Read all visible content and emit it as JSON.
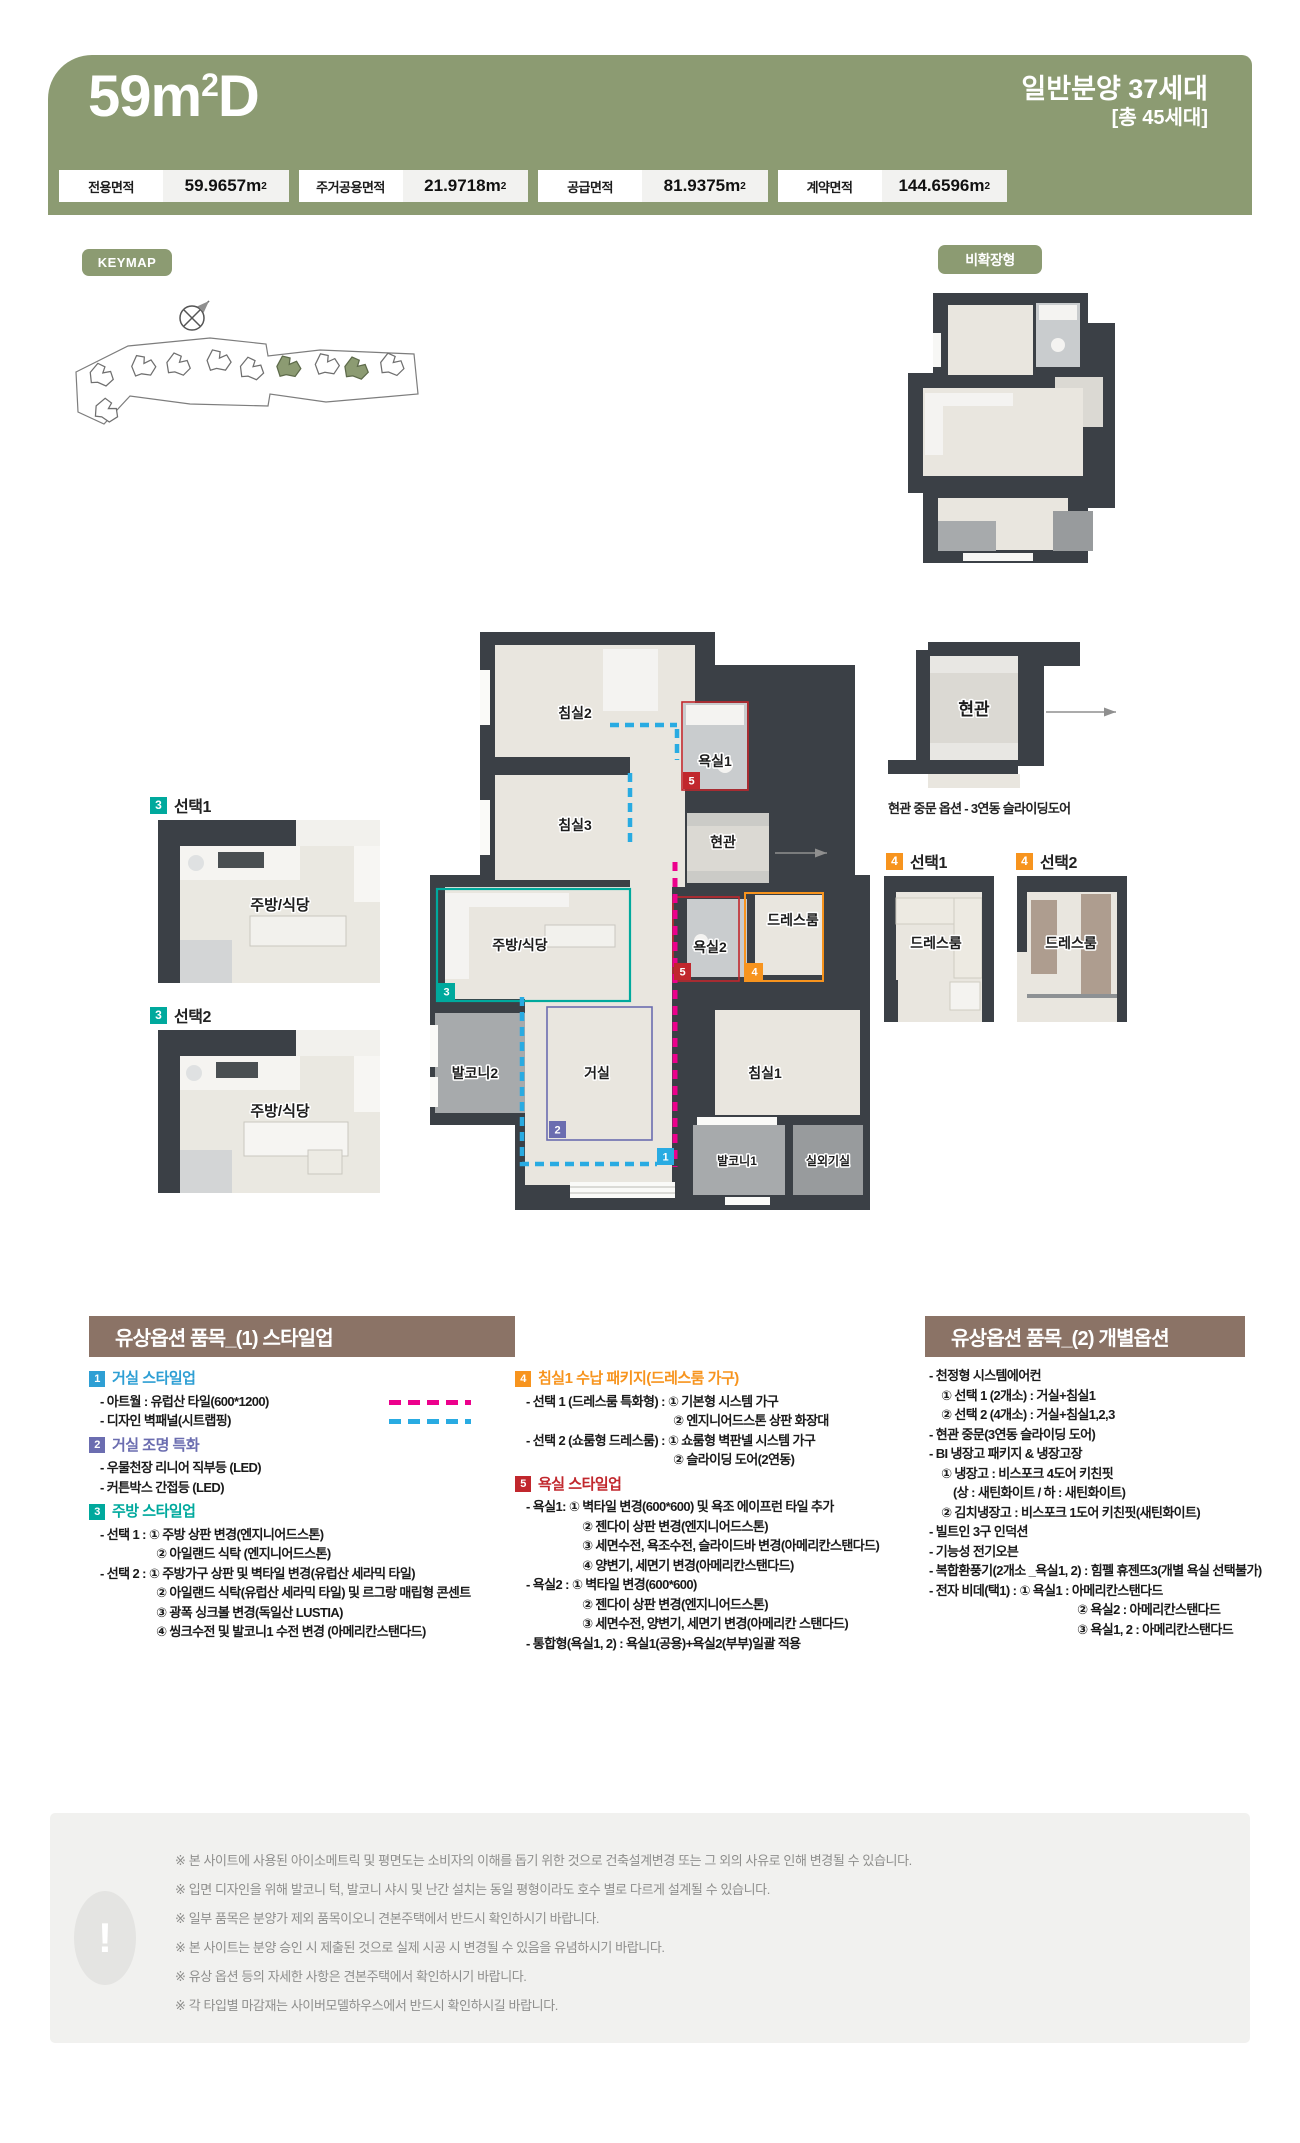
{
  "header": {
    "title_base": "59m",
    "title_sup": "2",
    "title_suffix": "D",
    "units_line1": "일반분양 37세대",
    "units_line2": "[총 45세대]",
    "olive_color": "#8C9B72",
    "areas": [
      {
        "label": "전용면적",
        "value": "59.9657",
        "unit_base": "m",
        "unit_sup": "2"
      },
      {
        "label": "주거공용면적",
        "value": "21.9718",
        "unit_base": "m",
        "unit_sup": "2"
      },
      {
        "label": "공급면적",
        "value": "81.9375",
        "unit_base": "m",
        "unit_sup": "2"
      },
      {
        "label": "계약면적",
        "value": "144.6596",
        "unit_base": "m",
        "unit_sup": "2"
      }
    ]
  },
  "keymap": {
    "badge": "KEYMAP"
  },
  "nonextended": {
    "badge": "비확장형"
  },
  "floorplan": {
    "rooms": {
      "bedroom2": "침실2",
      "bath1": "욕실1",
      "bedroom3": "침실3",
      "entrance": "현관",
      "kitchen": "주방/식당",
      "bath2": "욕실2",
      "dressroom": "드레스룸",
      "balcony2": "발코니2",
      "living": "거실",
      "bedroom1": "침실1",
      "balcony1": "발코니1",
      "outdoor": "실외기실"
    },
    "markers": {
      "m1": "1",
      "m2": "2",
      "m3": "3",
      "m4": "4",
      "m5": "5"
    },
    "marker_colors": {
      "m1": "#29ABE2",
      "m2": "#6B6DB0",
      "m3": "#00A99D",
      "m4": "#F7941E",
      "m5": "#C1272D"
    },
    "overlay_colors": {
      "magenta_dash": "#EC008C",
      "blue_dash": "#29ABE2"
    }
  },
  "side_options": {
    "kitchen": {
      "marker": "3",
      "opt1": "선택1",
      "opt2": "선택2",
      "room": "주방/식당"
    },
    "entrance": {
      "room": "현관",
      "caption": "현관 중문 옵션 - 3연동 슬라이딩도어"
    },
    "dress": {
      "marker": "4",
      "opt1": "선택1",
      "opt2": "선택2",
      "room": "드레스룸"
    }
  },
  "options1": {
    "title": "유상옵션 품목_(1) 스타일업",
    "groups": [
      {
        "num": "1",
        "heading": "거실 스타일업",
        "color": "#2E9FD4",
        "lines": [
          {
            "text": "- 아트월 : 유럽산 타일(600*1200)",
            "swatch": "magenta-dash"
          },
          {
            "text": "- 디자인 벽패널(시트랩핑)",
            "swatch": "blue-dash"
          }
        ]
      },
      {
        "num": "2",
        "heading": "거실 조명 특화",
        "color": "#6B6DB0",
        "lines": [
          {
            "text": "- 우물천장 리니어 직부등 (LED)"
          },
          {
            "text": "- 커튼박스 간접등 (LED)"
          }
        ]
      },
      {
        "num": "3",
        "heading": "주방 스타일업",
        "color": "#00A99D",
        "lines": [
          {
            "text": "- 선택 1 : ① 주방 상판 변경(엔지니어드스톤)"
          },
          {
            "text": "② 아일랜드 식탁 (엔지니어드스톤)"
          },
          {
            "text": "- 선택 2 : ① 주방가구 상판 및 벽타일 변경(유럽산 세라믹 타일)"
          },
          {
            "text": "② 아일랜드 식탁(유럽산 세라믹 타일) 및 르그랑 매립형 콘센트"
          },
          {
            "text": "③ 광폭 싱크볼 변경(독일산 LUSTIA)"
          },
          {
            "text": "④ 씽크수전 및 발코니1 수전 변경 (아메리칸스탠다드)"
          }
        ]
      },
      {
        "num": "4",
        "heading": "침실1 수납 패키지(드레스룸 가구)",
        "color": "#F7941E",
        "lines": [
          {
            "text": "- 선택 1 (드레스룸 특화형) : ① 기본형 시스템 가구"
          },
          {
            "text": "② 엔지니어드스톤 상판 화장대"
          },
          {
            "text": "- 선택 2 (쇼룸형 드레스룸) : ① 쇼룸형 벽판넬 시스템 가구"
          },
          {
            "text": "② 슬라이딩 도어(2연동)"
          }
        ]
      },
      {
        "num": "5",
        "heading": "욕실 스타일업",
        "color": "#C1272D",
        "lines": [
          {
            "text": "- 욕실1:  ① 벽타일 변경(600*600) 및 욕조 에이프런 타일 추가"
          },
          {
            "text": "② 젠다이 상판 변경(엔지니어드스톤)"
          },
          {
            "text": "③ 세면수전, 욕조수전, 슬라이드바 변경(아메리칸스탠다드)"
          },
          {
            "text": "④ 양변기, 세면기 변경(아메리칸스탠다드)"
          },
          {
            "text": "- 욕실2 : ① 벽타일 변경(600*600)"
          },
          {
            "text": "② 젠다이 상판 변경(엔지니어드스톤)"
          },
          {
            "text": "③ 세면수전, 양변기, 세면기 변경(아메리칸 스탠다드)"
          },
          {
            "text": "- 통합형(욕실1, 2) : 욕실1(공용)+욕실2(부부)일괄 적용"
          }
        ]
      }
    ]
  },
  "options2": {
    "title": "유상옵션 품목_(2) 개별옵션",
    "lines": [
      {
        "text": "- 천정형 시스템에어컨"
      },
      {
        "text": "① 선택 1 (2개소) : 거실+침실1"
      },
      {
        "text": "② 선택 2 (4개소) : 거실+침실1,2,3"
      },
      {
        "text": "- 현관 중문(3연동 슬라이딩 도어)"
      },
      {
        "text": "- BI 냉장고 패키지 & 냉장고장"
      },
      {
        "text": "① 냉장고 : 비스포크 4도어 키친핏"
      },
      {
        "text": "(상 : 새틴화이트 / 하 : 새틴화이트)"
      },
      {
        "text": "② 김치냉장고 : 비스포크 1도어 키친핏(새틴화이트)"
      },
      {
        "text": "- 빌트인 3구 인덕션"
      },
      {
        "text": "- 기능성 전기오븐"
      },
      {
        "text": "- 복합환풍기(2개소 _욕실1, 2) : 힘펠 휴젠뜨3(개별 욕실 선택불가)"
      },
      {
        "text": "- 전자 비데(택1) : ① 욕실1 : 아메리칸스탠다드"
      },
      {
        "text": "② 욕실2 : 아메리칸스탠다드"
      },
      {
        "text": "③ 욕실1, 2 : 아메리칸스탠다드"
      }
    ]
  },
  "footer": {
    "icon": "!",
    "lines": [
      "※ 본 사이트에 사용된 아이소메트릭 및 평면도는 소비자의 이해를 돕기 위한 것으로 건축설계변경 또는 그 외의 사유로 인해 변경될 수 있습니다.",
      "※ 입면 디자인을 위해 발코니 턱, 발코니 샤시 및 난간 설치는 동일 평형이라도 호수 별로 다르게 설계될 수 있습니다.",
      "※ 일부 품목은 분양가 제외 품목이오니 견본주택에서 반드시 확인하시기 바랍니다.",
      "※ 본 사이트는 분양 승인 시 제출된 것으로 실제 시공 시 변경될 수 있음을 유념하시기 바랍니다.",
      "※ 유상 옵션 등의 자세한 사항은 견본주택에서 확인하시기 바랍니다.",
      "※ 각 타입별 마감재는 사이버모델하우스에서 반드시 확인하시길 바랍니다."
    ]
  }
}
